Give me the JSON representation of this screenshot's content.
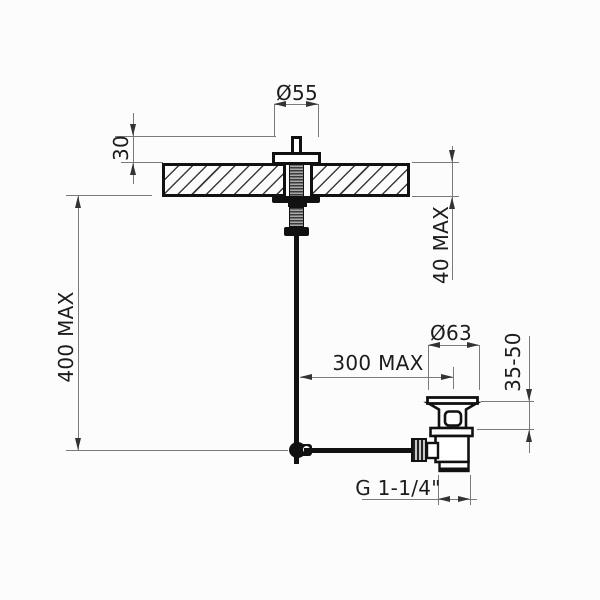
{
  "labels": {
    "dia55": "Ø55",
    "h30": "30",
    "v400max": "400 MAX",
    "v40max": "40 MAX",
    "dia63": "Ø63",
    "h300max": "300 MAX",
    "range3550": "35-50",
    "thread": "G 1-1/4\""
  },
  "colors": {
    "outline": "#111111",
    "dimension_line": "#7a7a7a",
    "text": "#1c1c1c",
    "background": "#fcfcfc"
  }
}
